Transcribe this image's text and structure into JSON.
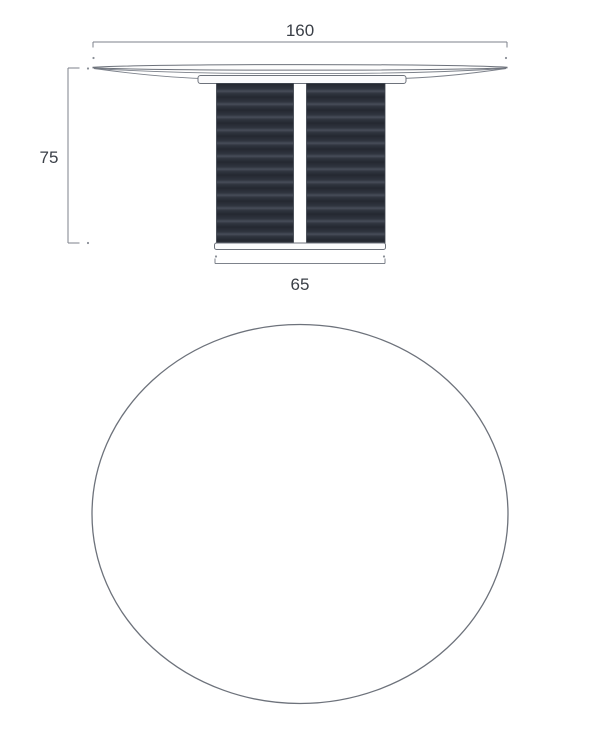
{
  "drawing": {
    "front_view": {
      "width_dimension": "160",
      "height_dimension": "75",
      "base_width_dimension": "65"
    },
    "colors": {
      "background": "#ffffff",
      "dimension_line": "#7d828b",
      "outline": "#6d727b",
      "label_text": "#3a3f47",
      "pedestal_dark": "#23272f",
      "pedestal_mid": "#30353f",
      "pedestal_light": "#474d59"
    }
  }
}
